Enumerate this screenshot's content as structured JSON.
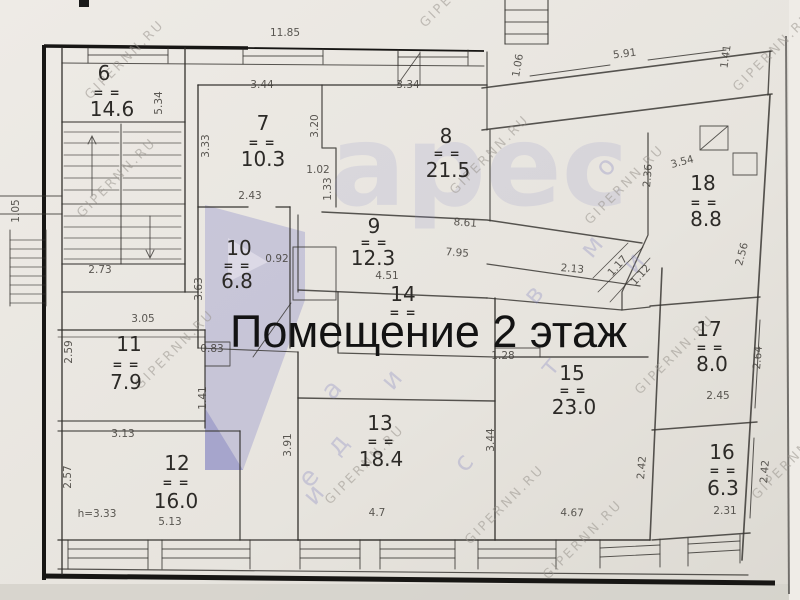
{
  "title_overlay": "Помещение 2 этаж",
  "room_mark": "= =",
  "watermark": {
    "site": "GIPERNN.RU",
    "logo_text": "арес",
    "logo_text_pos": {
      "x": 330,
      "y": 205
    },
    "logo_color": "#8686c7",
    "site_positions": [
      [
        90,
        100
      ],
      [
        82,
        218
      ],
      [
        140,
        390
      ],
      [
        330,
        505
      ],
      [
        425,
        28
      ],
      [
        455,
        195
      ],
      [
        470,
        545
      ],
      [
        590,
        225
      ],
      [
        640,
        395
      ],
      [
        548,
        580
      ],
      [
        738,
        92
      ],
      [
        757,
        500
      ]
    ],
    "scatter_letters": [
      {
        "ch": "а",
        "x": 338,
        "y": 395
      },
      {
        "ch": "и",
        "x": 398,
        "y": 385
      },
      {
        "ch": "д",
        "x": 344,
        "y": 450
      },
      {
        "ch": "е",
        "x": 315,
        "y": 483
      },
      {
        "ch": "и",
        "x": 320,
        "y": 500
      },
      {
        "ch": "в",
        "x": 540,
        "y": 300
      },
      {
        "ch": "о",
        "x": 612,
        "y": 172
      },
      {
        "ch": "и",
        "x": 640,
        "y": 268
      },
      {
        "ch": "м",
        "x": 598,
        "y": 252
      },
      {
        "ch": "с",
        "x": 470,
        "y": 468
      },
      {
        "ch": "т",
        "x": 556,
        "y": 372
      }
    ]
  },
  "rooms": [
    {
      "number": "6",
      "area": "14.6",
      "nx": 104,
      "ny": 80,
      "mx": 107,
      "my": 97,
      "ax": 112,
      "ay": 116
    },
    {
      "number": "7",
      "area": "10.3",
      "nx": 263,
      "ny": 130,
      "mx": 262,
      "my": 147,
      "ax": 263,
      "ay": 166
    },
    {
      "number": "8",
      "area": "21.5",
      "nx": 446,
      "ny": 143,
      "mx": 447,
      "my": 158,
      "ax": 448,
      "ay": 177
    },
    {
      "number": "9",
      "area": "12.3",
      "nx": 374,
      "ny": 233,
      "mx": 374,
      "my": 247,
      "ax": 373,
      "ay": 265
    },
    {
      "number": "10",
      "area": "6.8",
      "nx": 239,
      "ny": 255,
      "mx": 237,
      "my": 270,
      "ax": 237,
      "ay": 288
    },
    {
      "number": "11",
      "area": "7.9",
      "nx": 129,
      "ny": 351,
      "mx": 126,
      "my": 369,
      "ax": 126,
      "ay": 389
    },
    {
      "number": "12",
      "area": "16.0",
      "nx": 177,
      "ny": 470,
      "mx": 176,
      "my": 487,
      "ax": 176,
      "ay": 508
    },
    {
      "number": "13",
      "area": "18.4",
      "nx": 380,
      "ny": 430,
      "mx": 381,
      "my": 446,
      "ax": 381,
      "ay": 466
    },
    {
      "number": "14",
      "area": "",
      "nx": 403,
      "ny": 301,
      "mx": 403,
      "my": 317,
      "ax": 0,
      "ay": 0
    },
    {
      "number": "15",
      "area": "23.0",
      "nx": 572,
      "ny": 380,
      "mx": 573,
      "my": 395,
      "ax": 574,
      "ay": 414
    },
    {
      "number": "16",
      "area": "6.3",
      "nx": 722,
      "ny": 459,
      "mx": 723,
      "my": 475,
      "ax": 723,
      "ay": 495
    },
    {
      "number": "17",
      "area": "8.0",
      "nx": 709,
      "ny": 336,
      "mx": 710,
      "my": 352,
      "ax": 712,
      "ay": 371
    },
    {
      "number": "18",
      "area": "8.8",
      "nx": 703,
      "ny": 190,
      "mx": 704,
      "my": 207,
      "ax": 706,
      "ay": 226
    }
  ],
  "dimensions": [
    {
      "t": "11.85",
      "x": 285,
      "y": 36,
      "r": 0
    },
    {
      "t": "5.34",
      "x": 162,
      "y": 103,
      "r": -90
    },
    {
      "t": "3.44",
      "x": 262,
      "y": 88,
      "r": 0
    },
    {
      "t": "3.33",
      "x": 209,
      "y": 146,
      "r": -90
    },
    {
      "t": "3.34",
      "x": 408,
      "y": 88,
      "r": 0
    },
    {
      "t": "1.06",
      "x": 521,
      "y": 66,
      "r": -80
    },
    {
      "t": "5.91",
      "x": 625,
      "y": 57,
      "r": -7
    },
    {
      "t": "1.41",
      "x": 729,
      "y": 57,
      "r": -82
    },
    {
      "t": "2.43",
      "x": 250,
      "y": 199,
      "r": 0
    },
    {
      "t": "3.20",
      "x": 318,
      "y": 126,
      "r": -90
    },
    {
      "t": "1.02",
      "x": 318,
      "y": 173,
      "r": 0
    },
    {
      "t": "1.33",
      "x": 331,
      "y": 189,
      "r": -90
    },
    {
      "t": "8.61",
      "x": 465,
      "y": 226,
      "r": 4
    },
    {
      "t": "7.95",
      "x": 457,
      "y": 256,
      "r": 4
    },
    {
      "t": "2.13",
      "x": 572,
      "y": 272,
      "r": 5
    },
    {
      "t": "4.51",
      "x": 387,
      "y": 279,
      "r": 0
    },
    {
      "t": "1.28",
      "x": 503,
      "y": 359,
      "r": 0
    },
    {
      "t": "3.44",
      "x": 494,
      "y": 440,
      "r": -90
    },
    {
      "t": "2.42",
      "x": 645,
      "y": 468,
      "r": -85
    },
    {
      "t": "4.67",
      "x": 572,
      "y": 516,
      "r": 2
    },
    {
      "t": "4.7",
      "x": 377,
      "y": 516,
      "r": 0
    },
    {
      "t": "3.91",
      "x": 291,
      "y": 445,
      "r": -90
    },
    {
      "t": "1.41",
      "x": 206,
      "y": 398,
      "r": -90
    },
    {
      "t": "0.83",
      "x": 212,
      "y": 352,
      "r": 0
    },
    {
      "t": "3.05",
      "x": 143,
      "y": 322,
      "r": 0
    },
    {
      "t": "2.59",
      "x": 72,
      "y": 352,
      "r": -90
    },
    {
      "t": "3.13",
      "x": 123,
      "y": 437,
      "r": 0
    },
    {
      "t": "2.57",
      "x": 71,
      "y": 477,
      "r": -90
    },
    {
      "t": "h=3.33",
      "x": 97,
      "y": 517,
      "r": 0
    },
    {
      "t": "5.13",
      "x": 170,
      "y": 525,
      "r": 0
    },
    {
      "t": "3.63",
      "x": 202,
      "y": 289,
      "r": -90
    },
    {
      "t": "0.92",
      "x": 277,
      "y": 262,
      "r": 0
    },
    {
      "t": "2.73",
      "x": 100,
      "y": 273,
      "r": 0
    },
    {
      "t": "1.05",
      "x": 19,
      "y": 211,
      "r": -90
    },
    {
      "t": "2.36",
      "x": 651,
      "y": 176,
      "r": -85
    },
    {
      "t": "3.54",
      "x": 683,
      "y": 165,
      "r": -15
    },
    {
      "t": "2.56",
      "x": 745,
      "y": 255,
      "r": -75
    },
    {
      "t": "2.45",
      "x": 718,
      "y": 399,
      "r": 0
    },
    {
      "t": "2.64",
      "x": 761,
      "y": 358,
      "r": -85
    },
    {
      "t": "2.31",
      "x": 725,
      "y": 514,
      "r": 0
    },
    {
      "t": "2.42",
      "x": 768,
      "y": 472,
      "r": -85
    },
    {
      "t": "1.17",
      "x": 620,
      "y": 268,
      "r": -48
    },
    {
      "t": "1.12",
      "x": 643,
      "y": 277,
      "r": -48
    }
  ],
  "colors": {
    "paper": "#e9e6e1",
    "ink": "#2c2a27",
    "dim_ink": "#45423d",
    "scan_border": "#171614",
    "watermark_gray": "#9a958e",
    "logo_purple": "#8686c7",
    "overlay_text": "#131313"
  }
}
